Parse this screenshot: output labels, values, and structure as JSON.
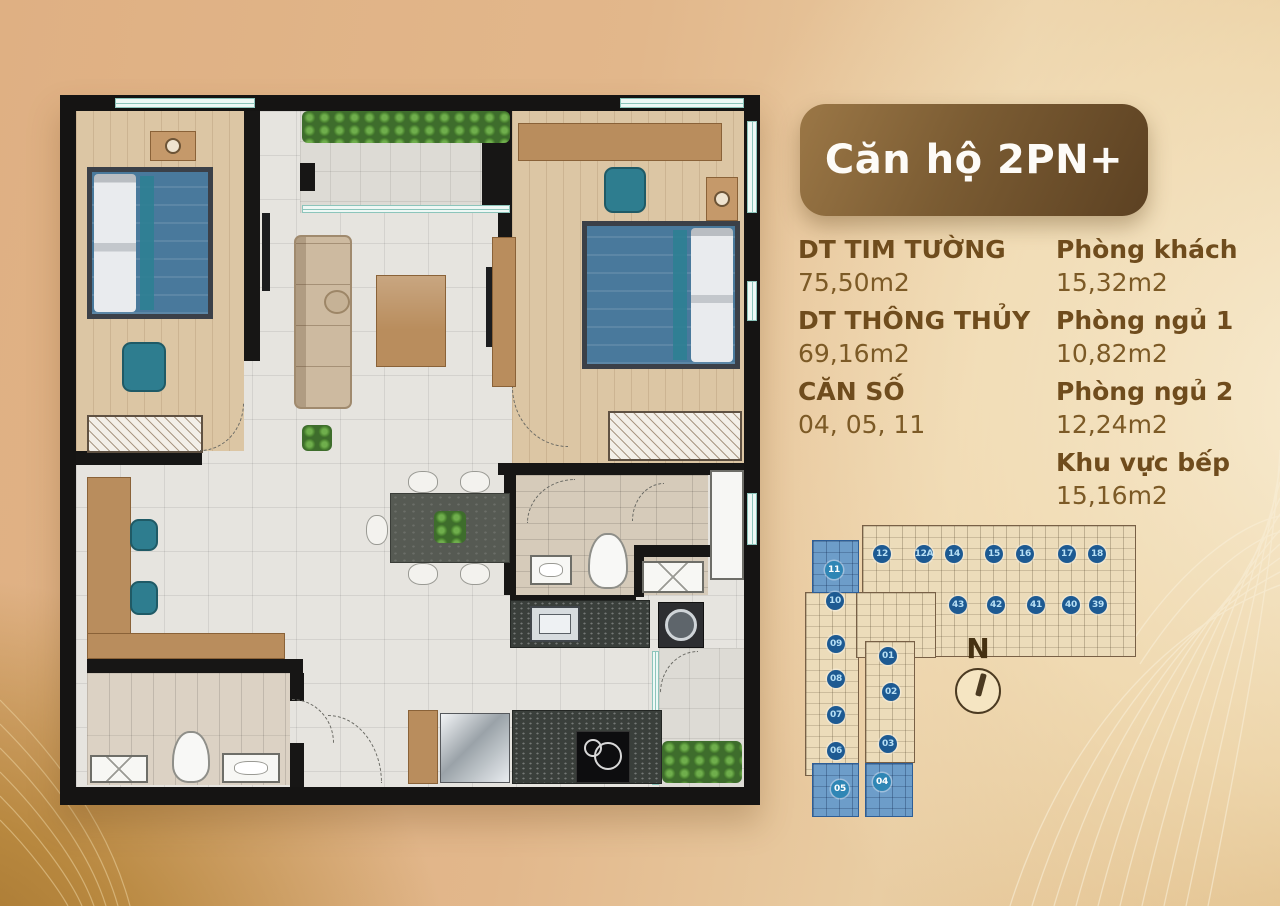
{
  "header": {
    "title": "Căn hộ 2PN+"
  },
  "info": {
    "left": [
      {
        "label": "DT TIM TƯỜNG",
        "value": "75,50m2"
      },
      {
        "label": "DT THÔNG THỦY",
        "value": "69,16m2"
      },
      {
        "label": "CĂN SỐ",
        "value": "04, 05, 11"
      }
    ],
    "right": [
      {
        "label": "Phòng khách",
        "value": "15,32m2"
      },
      {
        "label": "Phòng ngủ 1",
        "value": "10,82m2"
      },
      {
        "label": "Phòng ngủ 2",
        "value": "12,24m2"
      },
      {
        "label": "Khu vực bếp",
        "value": "15,16m2"
      }
    ]
  },
  "compass": {
    "label": "N"
  },
  "site_plan": {
    "highlighted_units": [
      "04",
      "05",
      "11"
    ],
    "badge_color": "#1d5a92",
    "highlight_color": "#6d9dc9",
    "units": [
      {
        "label": "12",
        "x": 82,
        "y": 49
      },
      {
        "label": "12A",
        "x": 124,
        "y": 49
      },
      {
        "label": "14",
        "x": 154,
        "y": 49
      },
      {
        "label": "15",
        "x": 194,
        "y": 49
      },
      {
        "label": "16",
        "x": 225,
        "y": 49
      },
      {
        "label": "17",
        "x": 267,
        "y": 49
      },
      {
        "label": "18",
        "x": 297,
        "y": 49
      },
      {
        "label": "43",
        "x": 158,
        "y": 100
      },
      {
        "label": "42",
        "x": 196,
        "y": 100
      },
      {
        "label": "41",
        "x": 236,
        "y": 100
      },
      {
        "label": "40",
        "x": 271,
        "y": 100
      },
      {
        "label": "39",
        "x": 298,
        "y": 100
      },
      {
        "label": "11",
        "x": 34,
        "y": 65,
        "highlighted": true
      },
      {
        "label": "10",
        "x": 35,
        "y": 96
      },
      {
        "label": "09",
        "x": 36,
        "y": 139
      },
      {
        "label": "08",
        "x": 36,
        "y": 174
      },
      {
        "label": "07",
        "x": 36,
        "y": 210
      },
      {
        "label": "06",
        "x": 36,
        "y": 246
      },
      {
        "label": "05",
        "x": 40,
        "y": 284,
        "highlighted": true
      },
      {
        "label": "01",
        "x": 88,
        "y": 151
      },
      {
        "label": "02",
        "x": 91,
        "y": 187
      },
      {
        "label": "03",
        "x": 88,
        "y": 239
      },
      {
        "label": "04",
        "x": 82,
        "y": 277,
        "highlighted": true
      }
    ]
  },
  "colors": {
    "page_background": "#e0b183",
    "badge_gradient_start": "#9b7746",
    "badge_gradient_end": "#5c4122",
    "text_brown": "#6f4c1d"
  }
}
